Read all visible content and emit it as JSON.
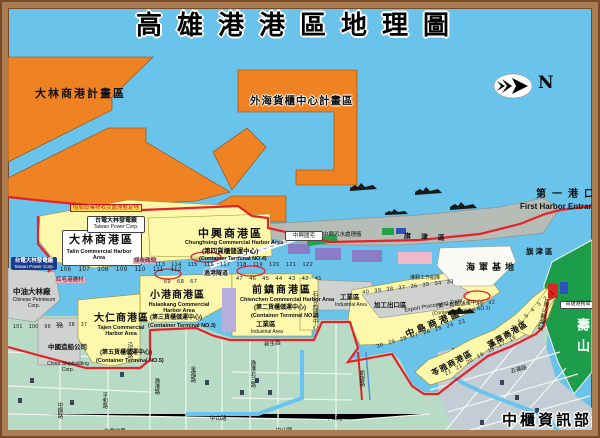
{
  "title": "高雄港港區地理圖",
  "credit": "中櫃資訊部繪製",
  "compass": {
    "n": "N"
  },
  "entrance": {
    "zh": "第一港口",
    "en": "First Harbor Entrance"
  },
  "planned_areas": {
    "dalin": "大林商港計畫區",
    "offshore": "外海貨櫃中心計畫區"
  },
  "harbors": {
    "talin": {
      "zh": "大林商港區",
      "en": "Talin Commercial Harbor Area"
    },
    "chunghsing": {
      "zh": "中興商港區",
      "en": "Chunghsing Commercial Harbor Area",
      "sub_zh": "(第四貨櫃儲運中心)",
      "sub_en": "(Container Terminal NO.4)"
    },
    "hsiaokang": {
      "zh": "小港商港區",
      "en": "Hsiaokang Commercial Harbor Area",
      "sub_zh": "(第三貨櫃儲運中心)",
      "sub_en": "(Container Terminal NO.3)"
    },
    "tajen": {
      "zh": "大仁商港區",
      "en": "Tajen Commercial Harbor Area",
      "sub_zh": "(第五貨櫃儲運中心)",
      "sub_en": "(Container Terminal NO.5)"
    },
    "chienchen": {
      "zh": "前鎮商港區",
      "en": "Chienchen Commercial Harbor Area",
      "sub_zh": "(第二貨櫃儲運中心)",
      "sub_en": "(Container Terminal NO.2)"
    },
    "chungtao": {
      "zh": "中島商港區"
    },
    "ct1": {
      "sub_zh": "(第一貨櫃儲運中心)",
      "sub_en": "(Container Terminal NO.1)"
    },
    "punglai": {
      "zh": "蓬萊商港區"
    },
    "lingya": {
      "zh": "苓雅商港區"
    }
  },
  "facilities": {
    "taipower": {
      "zh": "台電大林發電廠",
      "en": "Taiwan Power Corp."
    },
    "ship_waste": "船舶廢棄物收受處理暫定地",
    "cpc": {
      "zh": "中油大林廠",
      "en": "Chinese Petroleum Corp."
    },
    "hungmaokang": "紅毛港遷村",
    "coal_wharf": "煤炭碼頭",
    "csbc": {
      "zh": "中國造船公司",
      "en": "China Shipbuilding Corp."
    },
    "industrial": {
      "zh": "工業區",
      "en": "Industrial Area"
    },
    "petrochem": "石化品儲轉中心",
    "epz": {
      "zh": "加工出口區",
      "en": "Export Processing Zone"
    },
    "tunnel": "過港隧道",
    "chunghsing_housing": "中興國宅",
    "sewage": "中興污水處理廠",
    "navy_base": "海軍基地",
    "work_fleet": "港勤工作船隊",
    "gushan_ferry": "鼓山輪渡站",
    "harbor_bureau": "高雄港務局"
  },
  "districts": {
    "chijin": "旗津區",
    "shoushan": "壽山"
  },
  "streets": {
    "hsinsheng": "新生路",
    "chungshan": "中山路",
    "wufu": "五福路",
    "chinfu": "金福路",
    "yukang_n3": "漁港北三路",
    "yenhai": "沿海路",
    "pinghe": "平和路",
    "chungkang": "中鋼路",
    "yukang": "漁港路",
    "kaihsuan": "凱旋路",
    "tayeh_n": "大業北路"
  },
  "berths": {
    "talin": "106 107 108 109 110 111 112",
    "talin_w": "101 100 99 98",
    "chunghsing": "113 114 115 116 117 118 119 120 121 122",
    "hsiaokang": "69 68 67",
    "tajen": "39 38 37",
    "chienchen": "47 46 45 44 43 42 41",
    "chungtao_n": "40 39 38 37 36 35 34 33",
    "chungtao_s": "30 29 28 27 26 25 24 23",
    "ct1_pair": "41 42",
    "punglai": "22 21 20 19 18 17 16",
    "gushan": "9 8 7 6 5 4 3 2 1"
  },
  "colors": {
    "water": "#6ac3ea",
    "planned_orange": "#ef8222",
    "harbor_yellow": "#fdf8ab",
    "city_green": "#b7dbc4",
    "mountain_green": "#1d9c4a",
    "boundary_red": "#e62129",
    "sandbar_gray": "#b6bcb6",
    "frame_brown": "#a97c52"
  }
}
